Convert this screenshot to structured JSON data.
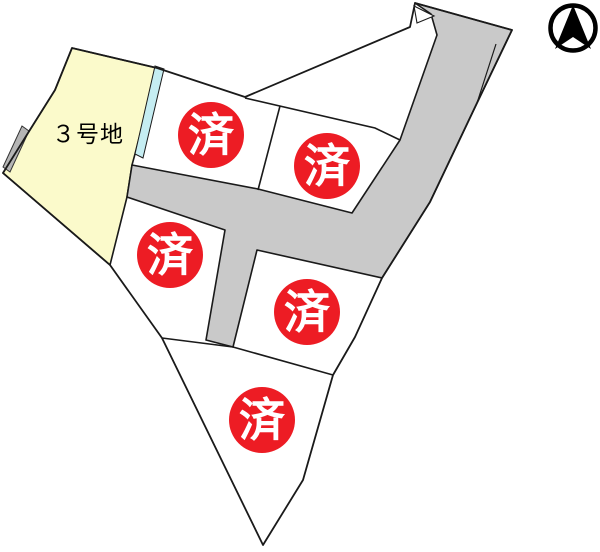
{
  "plan": {
    "available_lot_label": "３号地",
    "sold_label": "済",
    "sold_count": 5,
    "north_arrow": "north-arrow",
    "colors": {
      "background": "#ffffff",
      "line": "#1a1a1a",
      "road": "#c9c9c9",
      "available_lot_fill": "#fbfacb",
      "water_strip": "#c5edf2",
      "wall_strip": "#b5b5b5",
      "sold_badge_fill": "#ed1c24",
      "sold_badge_text": "#ffffff",
      "label_text": "#000000",
      "north_arrow_color": "#000000"
    }
  }
}
